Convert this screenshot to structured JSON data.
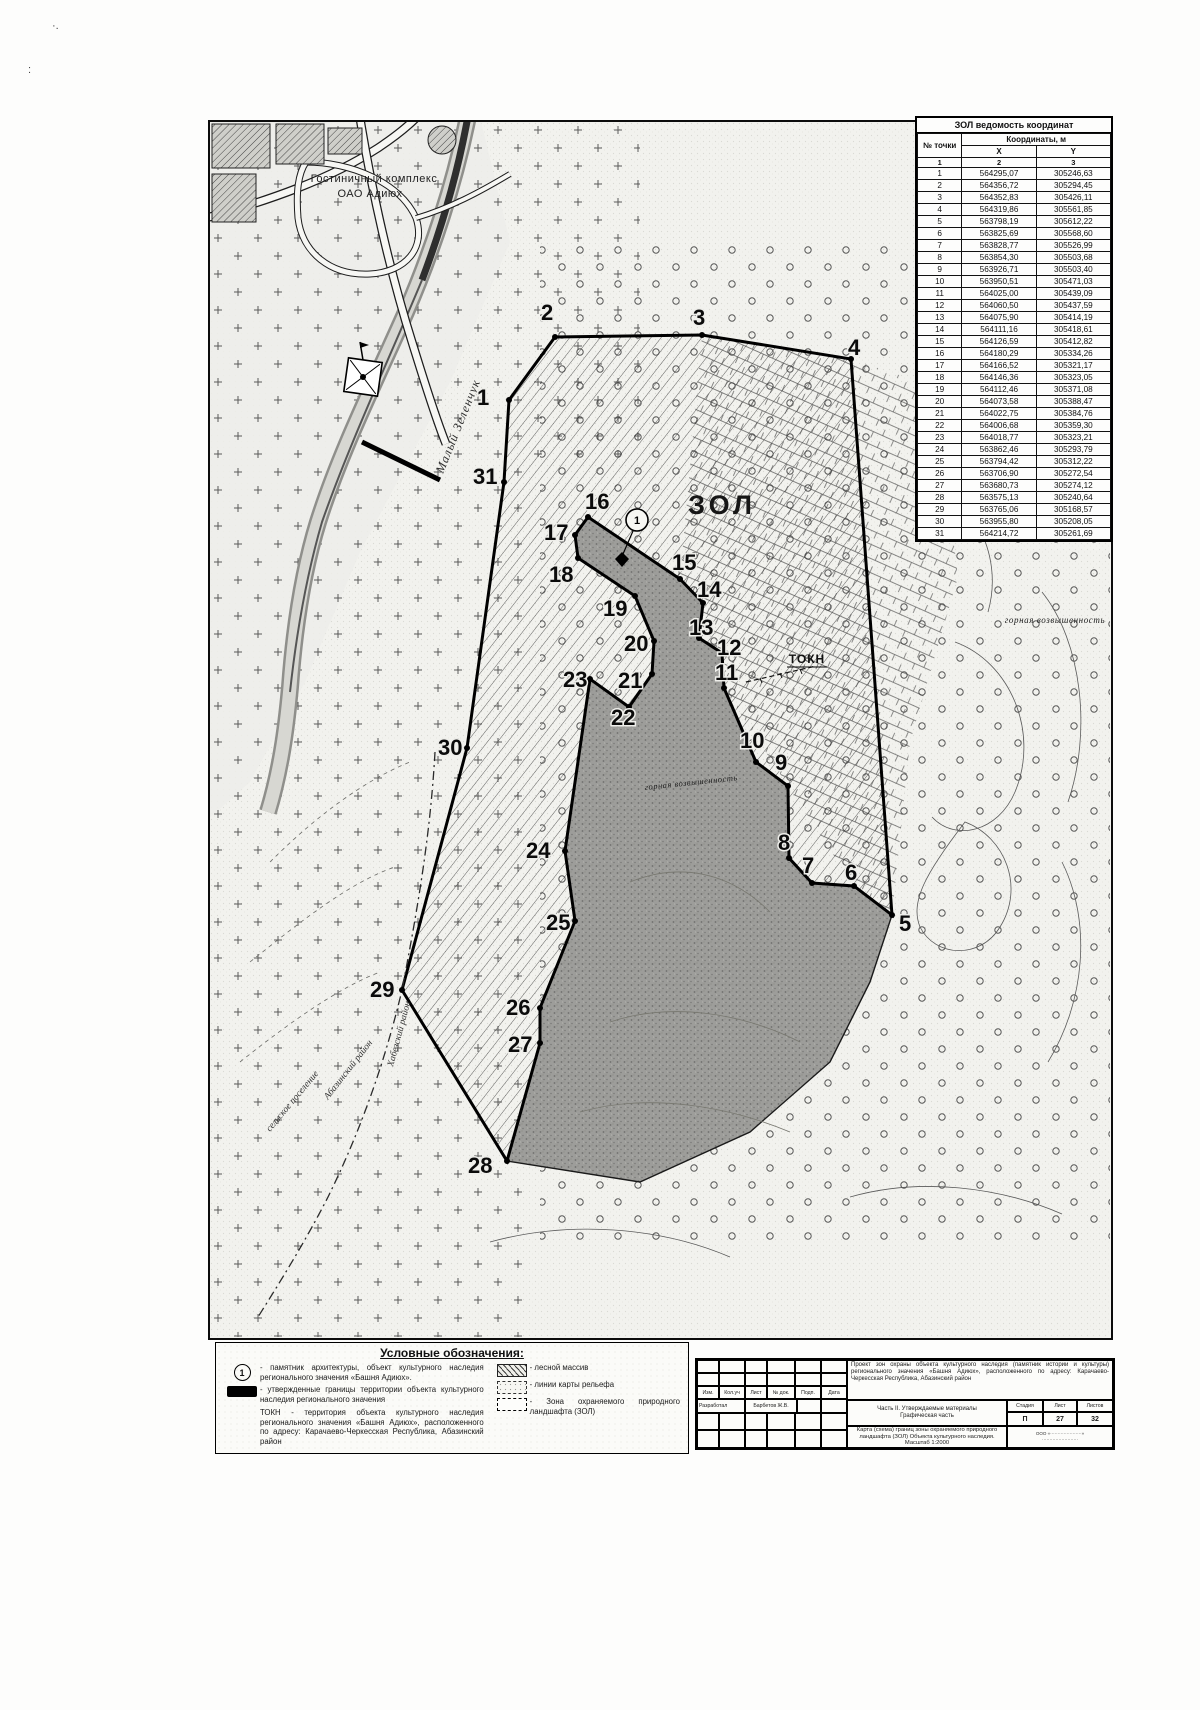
{
  "page": {
    "artifact_a": "·.",
    "artifact_b": ":"
  },
  "coordinates_table": {
    "title": "ЗОЛ ведомость координат",
    "col_point": "№ точки",
    "col_coords": "Координаты, м",
    "col_x": "X",
    "col_y": "Y",
    "num_row": [
      "1",
      "2",
      "3"
    ],
    "rows": [
      [
        "1",
        "564295,07",
        "305246,63"
      ],
      [
        "2",
        "564356,72",
        "305294,45"
      ],
      [
        "3",
        "564352,83",
        "305426,11"
      ],
      [
        "4",
        "564319,86",
        "305561,85"
      ],
      [
        "5",
        "563798,19",
        "305612,22"
      ],
      [
        "6",
        "563825,69",
        "305568,60"
      ],
      [
        "7",
        "563828,77",
        "305526,99"
      ],
      [
        "8",
        "563854,30",
        "305503,68"
      ],
      [
        "9",
        "563926,71",
        "305503,40"
      ],
      [
        "10",
        "563950,51",
        "305471,03"
      ],
      [
        "11",
        "564025,00",
        "305439,09"
      ],
      [
        "12",
        "564060,50",
        "305437,59"
      ],
      [
        "13",
        "564075,90",
        "305414,19"
      ],
      [
        "14",
        "564111,16",
        "305418,61"
      ],
      [
        "15",
        "564126,59",
        "305412,82"
      ],
      [
        "16",
        "564180,29",
        "305334,26"
      ],
      [
        "17",
        "564166,52",
        "305321,17"
      ],
      [
        "18",
        "564146,36",
        "305323,05"
      ],
      [
        "19",
        "564112,46",
        "305371,08"
      ],
      [
        "20",
        "564073,58",
        "305388,47"
      ],
      [
        "21",
        "564022,75",
        "305384,76"
      ],
      [
        "22",
        "564006,68",
        "305359,30"
      ],
      [
        "23",
        "564018,77",
        "305323,21"
      ],
      [
        "24",
        "563862,46",
        "305293,79"
      ],
      [
        "25",
        "563794,42",
        "305312,22"
      ],
      [
        "26",
        "563706,90",
        "305272,54"
      ],
      [
        "27",
        "563680,73",
        "305274,12"
      ],
      [
        "28",
        "563575,13",
        "305240,64"
      ],
      [
        "29",
        "563765,06",
        "305168,57"
      ],
      [
        "30",
        "563955,80",
        "305208,05"
      ],
      [
        "31",
        "564214,72",
        "305261,69"
      ]
    ]
  },
  "map": {
    "points": [
      {
        "n": "1",
        "vx": 299,
        "vy": 278,
        "lx": 267,
        "ly": 283
      },
      {
        "n": "2",
        "vx": 345,
        "vy": 215,
        "lx": 331,
        "ly": 198
      },
      {
        "n": "3",
        "vx": 492,
        "vy": 213,
        "lx": 483,
        "ly": 203
      },
      {
        "n": "4",
        "vx": 641,
        "vy": 237,
        "lx": 638,
        "ly": 233
      },
      {
        "n": "5",
        "vx": 682,
        "vy": 793,
        "lx": 689,
        "ly": 809
      },
      {
        "n": "6",
        "vx": 644,
        "vy": 764,
        "lx": 635,
        "ly": 758
      },
      {
        "n": "7",
        "vx": 602,
        "vy": 761,
        "lx": 592,
        "ly": 751
      },
      {
        "n": "8",
        "vx": 579,
        "vy": 736,
        "lx": 568,
        "ly": 728
      },
      {
        "n": "9",
        "vx": 578,
        "vy": 664,
        "lx": 565,
        "ly": 648
      },
      {
        "n": "10",
        "vx": 546,
        "vy": 640,
        "lx": 530,
        "ly": 626
      },
      {
        "n": "11",
        "vx": 514,
        "vy": 566,
        "lx": 505,
        "ly": 558
      },
      {
        "n": "12",
        "vx": 512,
        "vy": 531,
        "lx": 507,
        "ly": 533
      },
      {
        "n": "13",
        "vx": 489,
        "vy": 516,
        "lx": 479,
        "ly": 513
      },
      {
        "n": "14",
        "vx": 493,
        "vy": 481,
        "lx": 487,
        "ly": 475
      },
      {
        "n": "15",
        "vx": 470,
        "vy": 457,
        "lx": 462,
        "ly": 448
      },
      {
        "n": "16",
        "vx": 378,
        "vy": 395,
        "lx": 375,
        "ly": 387
      },
      {
        "n": "17",
        "vx": 365,
        "vy": 413,
        "lx": 334,
        "ly": 418
      },
      {
        "n": "18",
        "vx": 368,
        "vy": 436,
        "lx": 339,
        "ly": 460
      },
      {
        "n": "19",
        "vx": 425,
        "vy": 474,
        "lx": 393,
        "ly": 494
      },
      {
        "n": "20",
        "vx": 444,
        "vy": 519,
        "lx": 414,
        "ly": 529
      },
      {
        "n": "21",
        "vx": 442,
        "vy": 552,
        "lx": 408,
        "ly": 566
      },
      {
        "n": "22",
        "vx": 419,
        "vy": 585,
        "lx": 401,
        "ly": 603
      },
      {
        "n": "23",
        "vx": 380,
        "vy": 557,
        "lx": 353,
        "ly": 565
      },
      {
        "n": "24",
        "vx": 355,
        "vy": 729,
        "lx": 316,
        "ly": 736
      },
      {
        "n": "25",
        "vx": 365,
        "vy": 799,
        "lx": 336,
        "ly": 808
      },
      {
        "n": "26",
        "vx": 330,
        "vy": 886,
        "lx": 296,
        "ly": 893
      },
      {
        "n": "27",
        "vx": 330,
        "vy": 921,
        "lx": 298,
        "ly": 930
      },
      {
        "n": "28",
        "vx": 297,
        "vy": 1039,
        "lx": 258,
        "ly": 1051
      },
      {
        "n": "29",
        "vx": 192,
        "vy": 868,
        "lx": 160,
        "ly": 875
      },
      {
        "n": "30",
        "vx": 257,
        "vy": 626,
        "lx": 228,
        "ly": 633
      },
      {
        "n": "31",
        "vx": 294,
        "vy": 360,
        "lx": 263,
        "ly": 362
      }
    ],
    "dark_extra": [
      [
        660,
        860
      ],
      [
        620,
        940
      ],
      [
        540,
        1010
      ],
      [
        430,
        1060
      ]
    ],
    "dark_order": [
      16,
      15,
      14,
      13,
      12,
      11,
      10,
      9,
      8,
      7,
      6,
      5,
      -1,
      -2,
      -3,
      -4,
      28,
      27,
      26,
      25,
      24,
      23,
      22,
      21,
      20,
      19,
      18,
      17
    ],
    "labels": [
      {
        "text": "ЗОЛ",
        "x": 512,
        "y": 392,
        "rot": 0,
        "cls": "lbl-zol"
      },
      {
        "text": "ТОКН",
        "x": 597,
        "y": 541,
        "rot": 0,
        "cls": "lbl-tokn"
      },
      {
        "text": "Малый Зеленчук",
        "x": 233,
        "y": 352,
        "rot": -68,
        "cls": "lbl-river"
      },
      {
        "text": "Гостиничный комплекс",
        "x": 164,
        "y": 60,
        "rot": 0,
        "cls": "lbl-hotel"
      },
      {
        "text": "ОАО Адиюх",
        "x": 160,
        "y": 75,
        "rot": 0,
        "cls": "lbl-hotel"
      },
      {
        "text": "Хабезский район",
        "x": 183,
        "y": 945,
        "rot": -75,
        "cls": "lbl-it"
      },
      {
        "text": "Абазинский район",
        "x": 118,
        "y": 978,
        "rot": -52,
        "cls": "lbl-it"
      },
      {
        "text": "сельское поселение",
        "x": 60,
        "y": 1010,
        "rot": -50,
        "cls": "lbl-it"
      },
      {
        "text": "горная возвышенность",
        "x": 435,
        "y": 668,
        "rot": -6,
        "cls": "lbl-dark"
      },
      {
        "text": "горная возвышенность",
        "x": 845,
        "y": 501,
        "rot": 0,
        "cls": "lbl-hill"
      },
      {
        "text": "1",
        "x": 427,
        "y": 402,
        "rot": 0,
        "cls": "lbl-monu"
      }
    ]
  },
  "legend": {
    "title": "Условные обозначения:",
    "monument_symbol": "1",
    "items_left": [
      {
        "text": "- памятник архитектуры, объект культурного наследия регионального значения «Башня Адиюх»."
      },
      {
        "text": "- утвержденные границы территории объекта культурного наследия регионального значения"
      },
      {
        "text": "ТОКН - территория объекта культурного наследия регионального значения «Башня Адиюх», расположенного по адресу: Карачаево-Черкесская Республика, Абазинский район"
      }
    ],
    "items_right": [
      {
        "text": "- лесной массив"
      },
      {
        "text": "- линии карты рельефа"
      },
      {
        "text": "- Зона охраняемого природного ландшафта (ЗОЛ)"
      }
    ]
  },
  "stamp": {
    "cols": [
      "Изм.",
      "Кол.уч",
      "Лист",
      "№ док.",
      "Подп.",
      "Дата"
    ],
    "role": "Разработал",
    "name": "Барбетов Ж.В.",
    "project": "Проект зон охраны объекта культурного наследия (памятник истории и культуры) регионального значения «Башня Адиюх», расположенного по адресу: Карачаево-Черкесская Республика, Абазинский район",
    "part_line1": "Часть II. Утверждаемые материалы",
    "part_line2": "Графическая часть",
    "stage_label": "Стадия",
    "sheet_label": "Лист",
    "sheets_label": "Листов",
    "stage": "П",
    "sheet": "27",
    "sheets": "32",
    "map_title": "Карта (схема) границ зоны охраняемого природного ландшафта (ЗОЛ) Объекта культурного наследия. Масштаб 1:2000",
    "org_line1": "ООО «·····················»",
    "org_line2": "························"
  }
}
